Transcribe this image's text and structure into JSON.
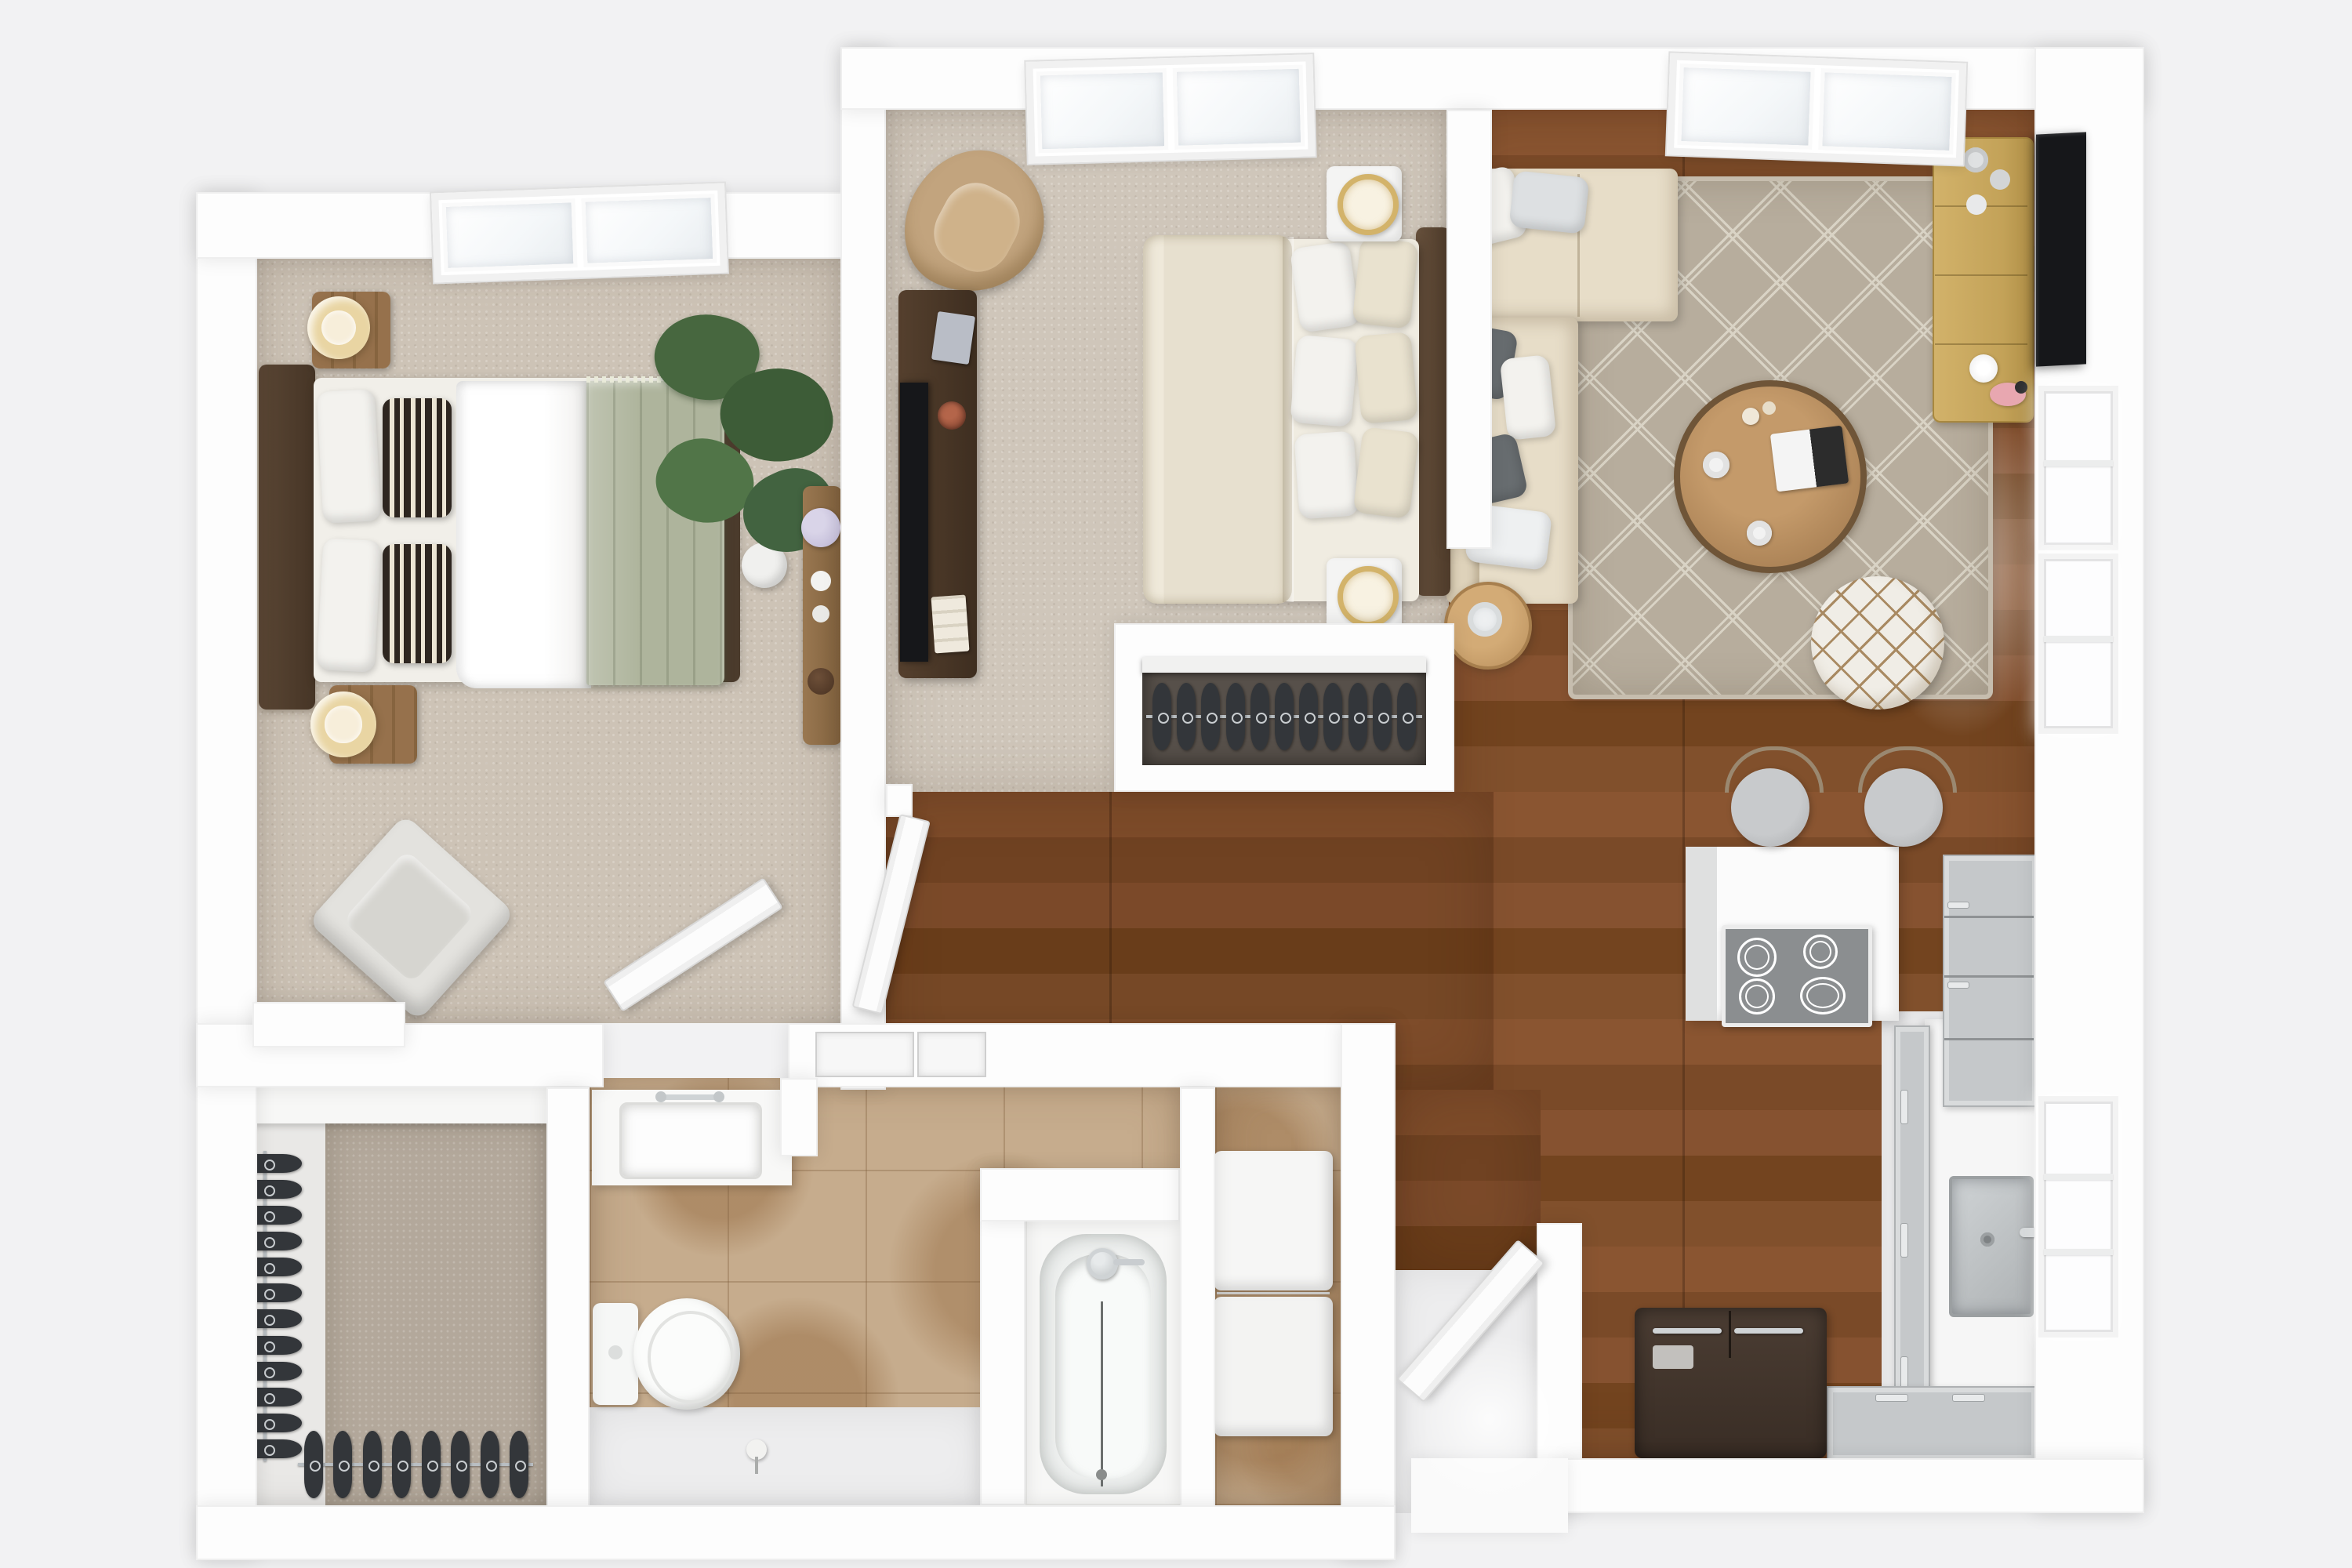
{
  "meta": {
    "title": "3D top-view floor plan — two-bedroom apartment render",
    "style": "photoreal dollhouse top-down"
  },
  "palette": {
    "bg": "#f2f2f3",
    "wall": "#fdfdfd",
    "carpet": "#cdc3b6",
    "carpet2": "#cfc6ba",
    "carpetCloset": "#b3a89b",
    "closetDark": "#57504a",
    "tile": "#c6ac8d",
    "floorWhite": "#ededee",
    "sofaCream": "#e7ddc8",
    "sage": "#aeb49c",
    "darkWood": "#4a3829",
    "midWood": "#8d6b49",
    "goldWood": "#c8a85f",
    "greyCab": "#c5c8ca",
    "cooktop": "#8b8e90",
    "steel": "#b9bcbe",
    "tvBlack": "#16171a",
    "pillowGray": "#686d70",
    "pillowLight": "#dde0e2",
    "rug": "#b7ad9d",
    "rugLine": "#d9d3c5",
    "pouf": "#f0ede6",
    "poufLine": "#a98a62",
    "tan": "#c2a47e",
    "fridge": "#41342b",
    "lamp": "#e9d5a3",
    "lampIn": "#f7eeda",
    "plantGreen": "#46663f",
    "flowerLilac": "#c9c3dd",
    "pinkAccent": "#e8a7b0"
  },
  "rooms": [
    {
      "id": "master-bedroom",
      "name": "Master Bedroom",
      "floor": "beige carpet"
    },
    {
      "id": "bedroom-2",
      "name": "Bedroom 2",
      "floor": "beige carpet"
    },
    {
      "id": "living-room",
      "name": "Living Room",
      "floor": "hardwood"
    },
    {
      "id": "kitchen",
      "name": "Kitchen",
      "floor": "hardwood + white"
    },
    {
      "id": "hallway",
      "name": "Hallway",
      "floor": "hardwood"
    },
    {
      "id": "bathroom",
      "name": "Bathroom",
      "floor": "stone tile"
    },
    {
      "id": "laundry",
      "name": "Laundry Closet",
      "floor": "stone tile"
    },
    {
      "id": "walk-in-closet",
      "name": "Walk-in Closet",
      "floor": "carpet"
    },
    {
      "id": "reach-in-closet",
      "name": "Reach-in Closet",
      "floor": "dark carpet"
    },
    {
      "id": "entry",
      "name": "Entry",
      "floor": "white"
    }
  ],
  "furniture": {
    "master_bed": "Platform bed with sage green throw and striped pillows",
    "master_nightstands": "Pair of wood nightstands with round cream lamps",
    "master_plant": "Potted monstera plant",
    "master_console": "Wood console with hydrangeas",
    "master_chair": "White lounge chair",
    "bed2": "Queen bed with cream duvet",
    "bed2_chair": "Tan wingback chair",
    "bed2_media": "Dark media console with TV",
    "sofa": "Cream L-sectional sofa with gray pillows",
    "coffee_table": "Round reclaimed-wood coffee table",
    "pouf": "White Moroccan pouf",
    "side_table": "Round side table with candle",
    "tv_console": "Light oak TV console",
    "tv": "Wall-mounted flat-screen TV",
    "rug": "Beige diamond-pattern area rug",
    "stools": "Two counter stools",
    "cooktop": "4-burner electric cooktop",
    "sink": "Stainless under-mount sink",
    "fridge": "French-door refrigerator",
    "toilet": "Toilet",
    "vanity": "Vanity with sink",
    "bathtub": "Alcove bathtub with shower",
    "washer_dryer": "Stacked washer and dryer"
  },
  "closets": {
    "reach_in": {
      "hanger_count": 11
    },
    "walk_in_side": {
      "hanger_count": 12
    },
    "walk_in_bottom": {
      "hanger_count": 8
    }
  },
  "openings": {
    "skylights": 3,
    "windows_east": 3,
    "doors": [
      "master bedroom door",
      "hall door",
      "front door"
    ]
  }
}
